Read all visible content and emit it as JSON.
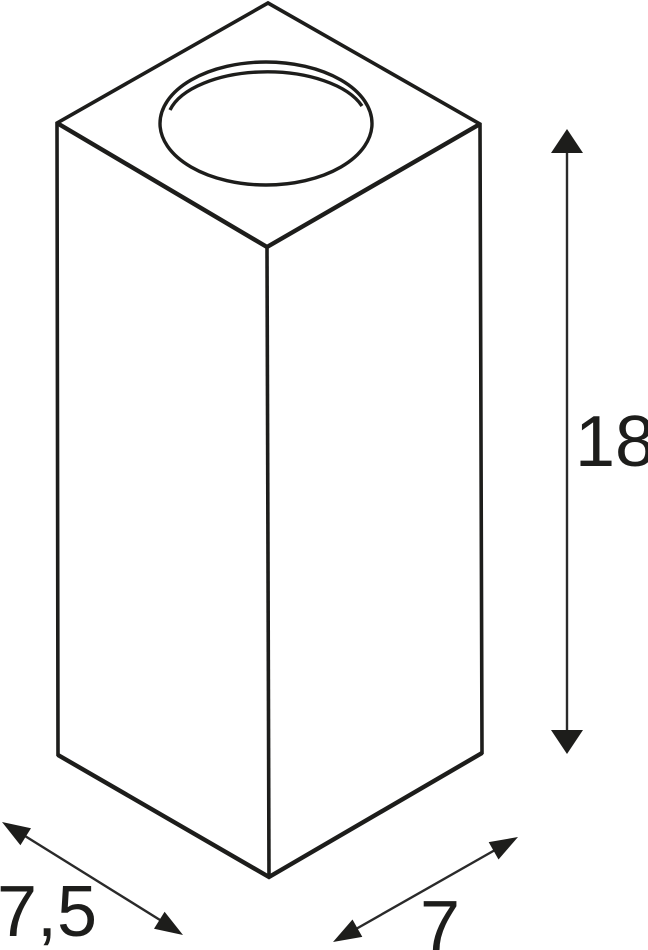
{
  "drawing": {
    "kind": "technical-dimension-drawing",
    "background": "#ffffff",
    "line_color": "#1d1d1b",
    "dimensions": {
      "height": {
        "label": "18"
      },
      "depth": {
        "label": "7,5"
      },
      "width": {
        "label": "7"
      }
    }
  }
}
